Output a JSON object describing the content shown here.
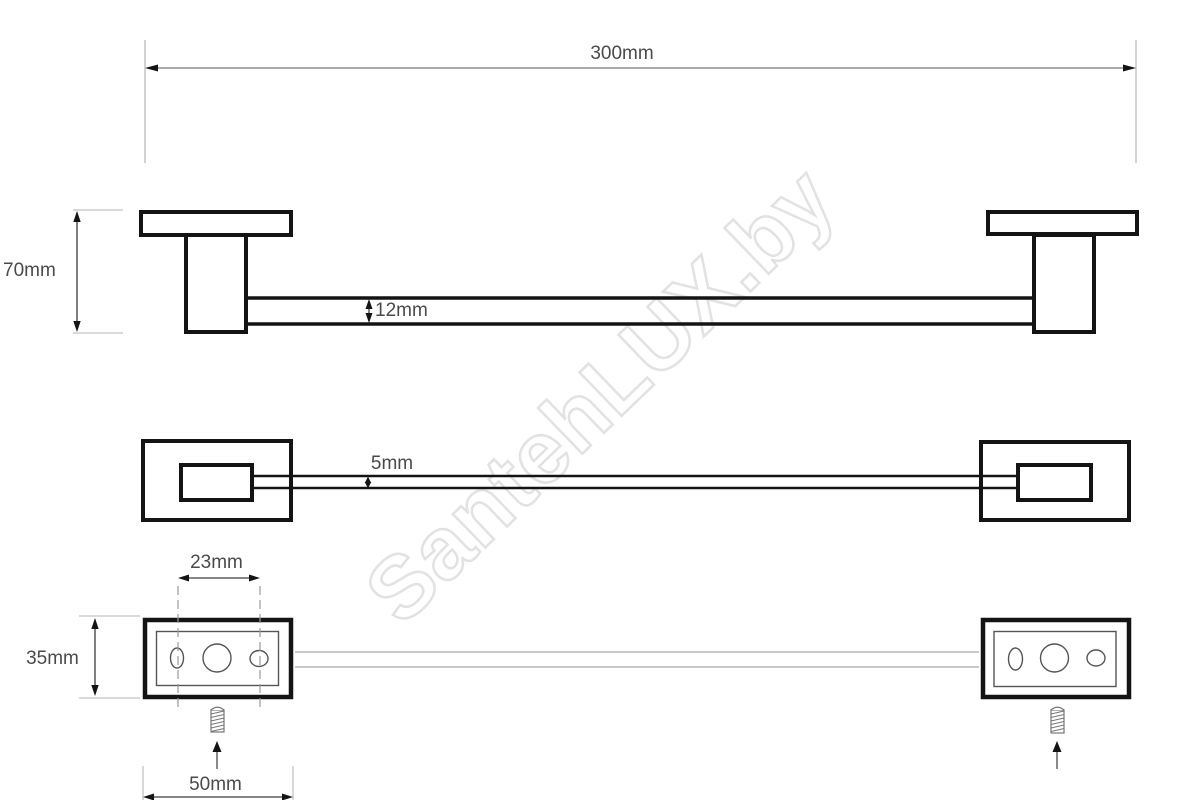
{
  "watermark": {
    "text": "SantehLUX.by"
  },
  "labels": {
    "overall_length": "300mm",
    "bracket_height": "70mm",
    "bar_profile_height": "12mm",
    "bar_profile_depth": "5mm",
    "hole_spacing": "23mm",
    "base_height": "35mm",
    "base_width": "50mm"
  },
  "colors": {
    "outline": "#141414",
    "dimension_line": "#3c3c3c",
    "light_dimension_line": "#ababab",
    "extension_line": "#c4c4c4",
    "centerline": "#9a9a9a",
    "hidden_bar_line": "#c9c9c9",
    "detail_line": "#555555",
    "screw_line": "#777777",
    "label_text": "#4a4a4a",
    "watermark_outline": "#e2e2e2",
    "background": "#ffffff"
  }
}
